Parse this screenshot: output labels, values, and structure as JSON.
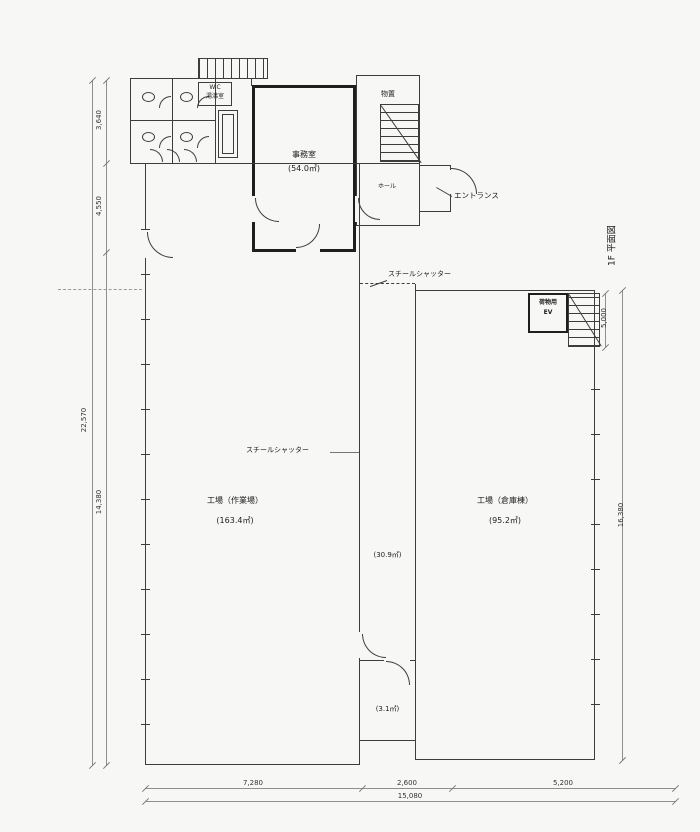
{
  "rooms": {
    "office": {
      "name": "事務室",
      "area": "(54.0㎡)"
    },
    "storage": {
      "name": "物置"
    },
    "hall": {
      "name": "ホール"
    },
    "workshop": {
      "name": "工場（作業場）",
      "area": "(163.4㎡)"
    },
    "warehouse": {
      "name": "工場（倉庫棟）",
      "area": "(95.2㎡)"
    },
    "corridor_area": "(30.9㎡)",
    "small_room_area": "(3.1㎡)",
    "freight_ev": {
      "line1": "荷物用",
      "line2": "EV"
    },
    "wc_block": {
      "line1": "W.C",
      "line2": "湯沸室"
    }
  },
  "annotations": {
    "entrance": "エントランス",
    "shutter_top": "スチールシャッター",
    "shutter_mid": "スチールシャッター",
    "plan_title": "1F 平面図"
  },
  "dimensions": {
    "left_segments": [
      "3,640",
      "4,550",
      "14,380"
    ],
    "left_total": "22,570",
    "bottom_segments": [
      "7,280",
      "2,600",
      "5,200"
    ],
    "bottom_total": "15,080",
    "right_stair": "5,000",
    "right_total": "16,380"
  },
  "colors": {
    "line": "#3d3d3d",
    "paper": "#f7f7f5"
  }
}
